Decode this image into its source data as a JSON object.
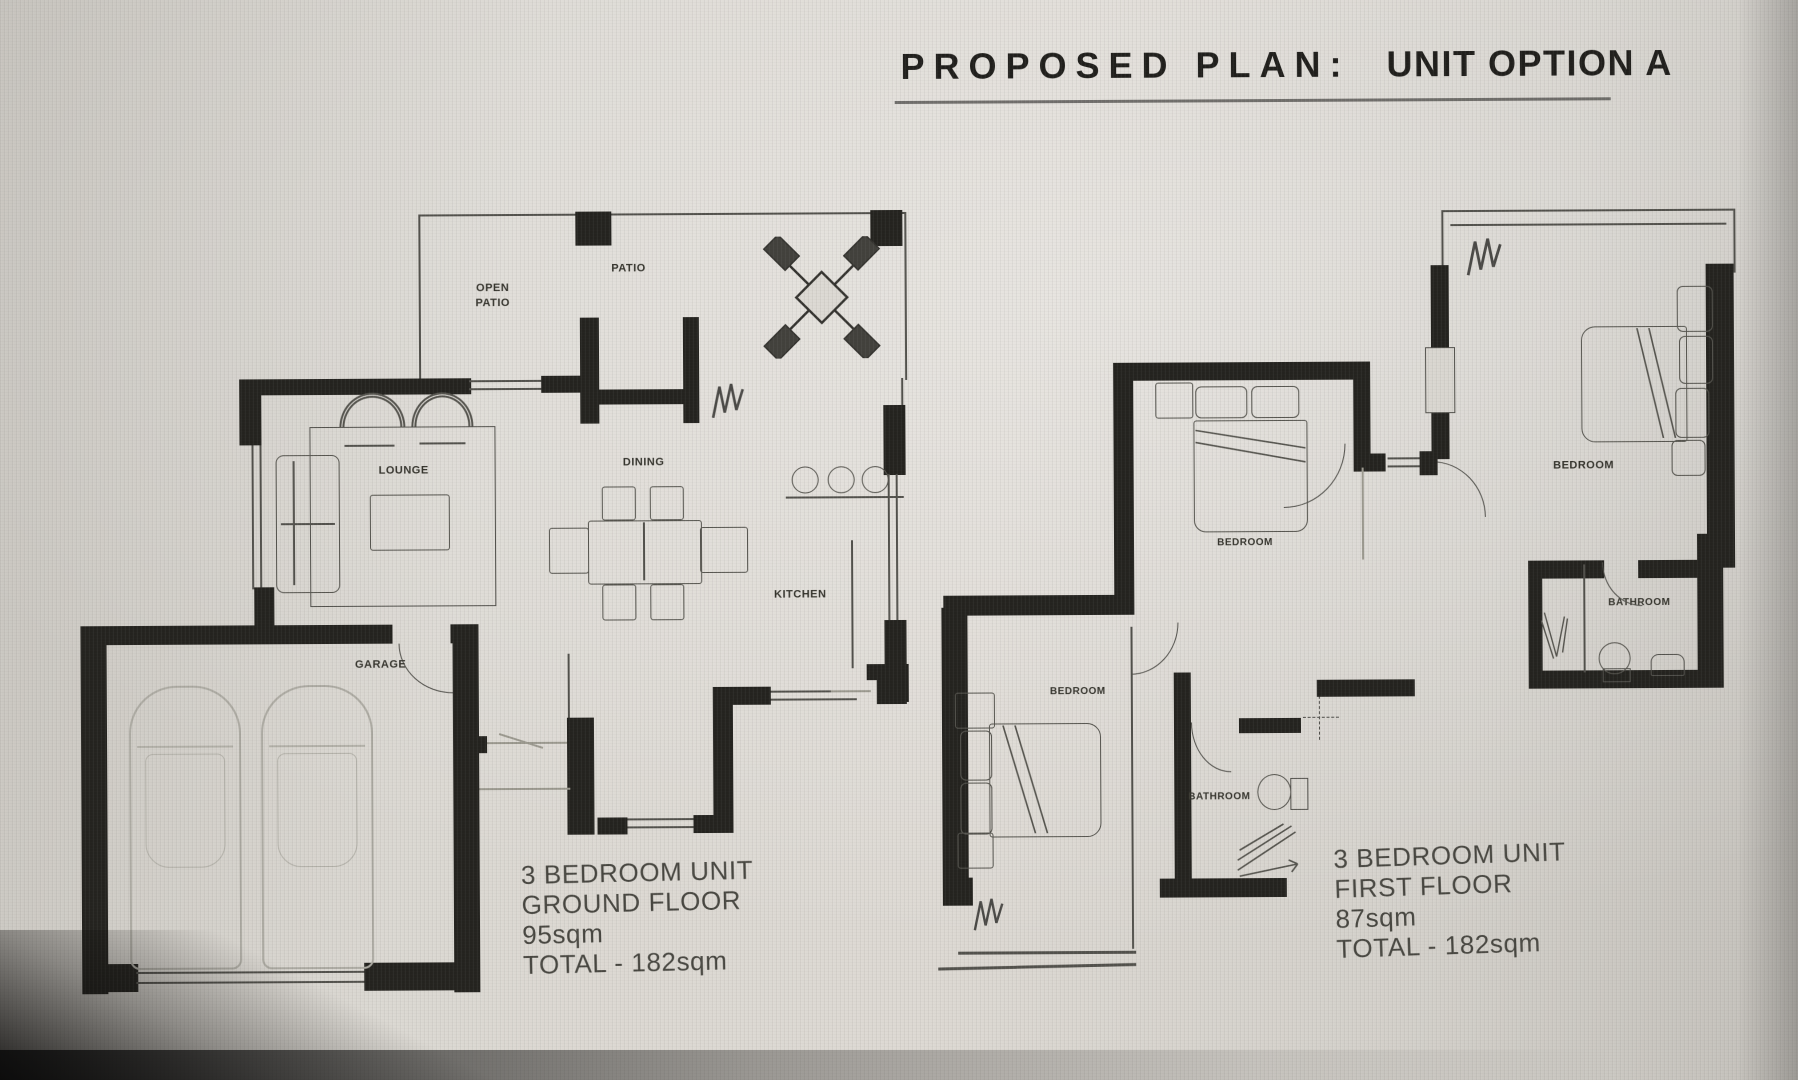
{
  "title": {
    "plan": "PROPOSED PLAN:",
    "option": "UNIT OPTION A"
  },
  "ground_floor": {
    "labels": {
      "open_patio_line1": "OPEN",
      "open_patio_line2": "PATIO",
      "patio": "PATIO",
      "lounge": "LOUNGE",
      "dining": "DINING",
      "kitchen": "KITCHEN",
      "garage": "GARAGE"
    },
    "caption": {
      "line1": "3 BEDROOM UNIT",
      "line2": "GROUND FLOOR",
      "line3": "95sqm",
      "line4": "TOTAL - 182sqm"
    }
  },
  "first_floor": {
    "labels": {
      "bedroom_top_left": "BEDROOM",
      "bedroom_right": "BEDROOM",
      "bedroom_lower_left": "BEDROOM",
      "bathroom_right": "BATHROOM",
      "bathroom_middle": "BATHROOM"
    },
    "caption": {
      "line1": "3 BEDROOM UNIT",
      "line2": "FIRST FLOOR",
      "line3": "87sqm",
      "line4": "TOTAL - 182sqm"
    }
  },
  "colors": {
    "wall": "#24231f",
    "thin_line": "#52514c",
    "label": "#35342d",
    "paper": "#d9d6d0"
  }
}
